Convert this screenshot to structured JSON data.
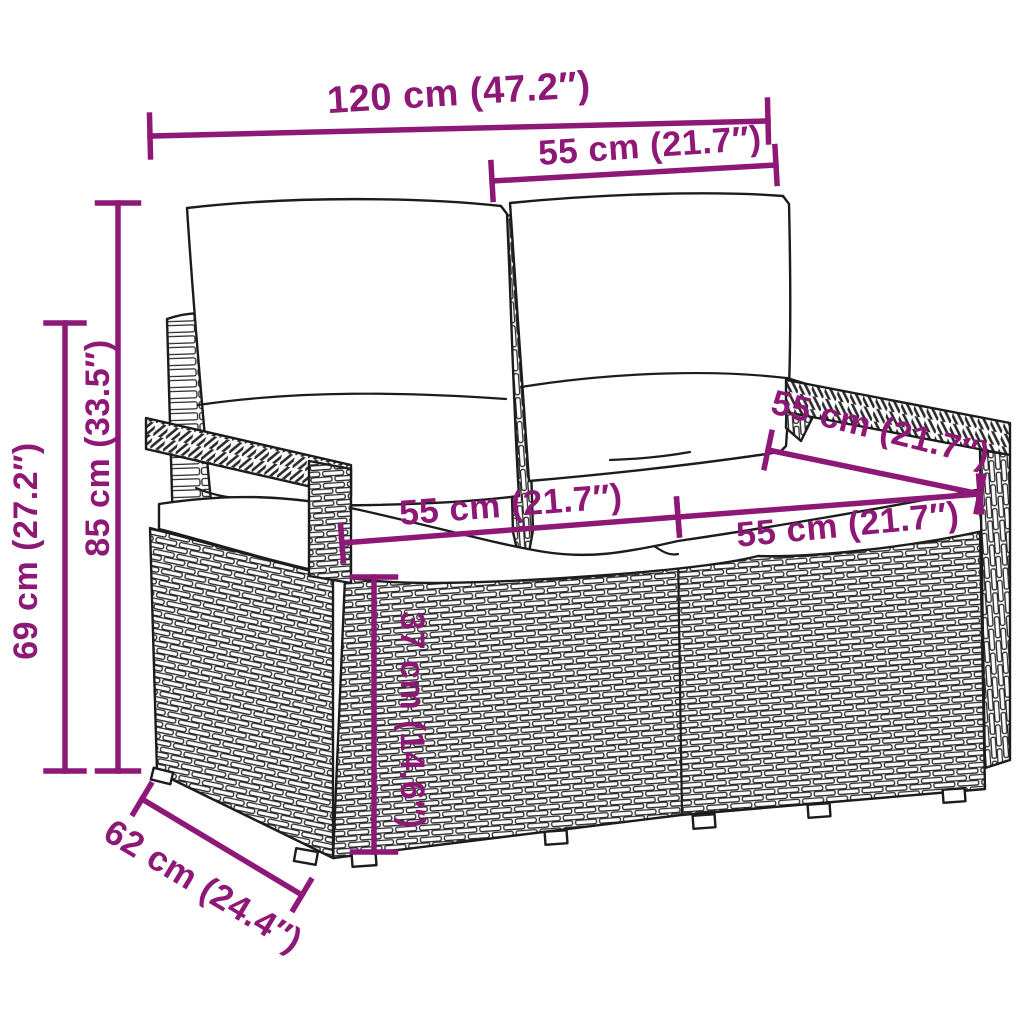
{
  "diagram": {
    "title": "Poly rattan 2-seater garden sofa with cushions — dimension diagram",
    "accent_color": "#8E1876",
    "outline_color": "#1C1C1C",
    "background_color": "#FFFFFF",
    "canvas": {
      "width": 1024,
      "height": 1024
    }
  },
  "dimensions": [
    {
      "id": "overall-width",
      "label": "120 cm (47.2″)",
      "x1": 150,
      "y1": 136,
      "x2": 768,
      "y2": 121,
      "tick": 42,
      "label_x": 459,
      "label_y": 95,
      "label_rotate": -3.5,
      "font_size": 38
    },
    {
      "id": "backrest-width-right",
      "label": "55 cm (21.7″)",
      "x1": 492,
      "y1": 181,
      "x2": 776,
      "y2": 165,
      "tick": 37,
      "label_x": 650,
      "label_y": 148,
      "label_rotate": -4,
      "font_size": 35
    },
    {
      "id": "overall-height",
      "label": "85 cm (33.5″)",
      "x1": 118,
      "y1": 203,
      "x2": 118,
      "y2": 771,
      "tick": 41,
      "label_x": 100,
      "label_y": 448,
      "label_rotate": -90,
      "font_size": 34
    },
    {
      "id": "armrest-height",
      "label": "69 cm (27.2″)",
      "x1": 65,
      "y1": 323,
      "x2": 65,
      "y2": 771,
      "tick": 38,
      "label_x": 28,
      "label_y": 551,
      "label_rotate": -90,
      "font_size": 34
    },
    {
      "id": "seat-width-left",
      "label": "55 cm (21.7″)",
      "x1": 342,
      "y1": 543,
      "x2": 678,
      "y2": 517,
      "tick": 36,
      "label_x": 511,
      "label_y": 507,
      "label_rotate": -4.5,
      "font_size": 35
    },
    {
      "id": "seat-width-right",
      "label": "55 cm (21.7″)",
      "x1": 678,
      "y1": 517,
      "x2": 980,
      "y2": 494,
      "tick": 36,
      "label_x": 848,
      "label_y": 527,
      "label_rotate": -5.5,
      "font_size": 35
    },
    {
      "id": "seat-depth-top",
      "label": "55 cm (21.7″)",
      "x1": 768,
      "y1": 450,
      "x2": 980,
      "y2": 494,
      "tick": 36,
      "label_x": 880,
      "label_y": 431,
      "label_rotate": 14,
      "font_size": 35
    },
    {
      "id": "seat-base-height",
      "label": "37 cm (14.6″)",
      "x1": 374,
      "y1": 577,
      "x2": 374,
      "y2": 852,
      "tick": 43,
      "label_x": 410,
      "label_y": 720,
      "label_rotate": 90,
      "font_size": 34
    },
    {
      "id": "overall-depth",
      "label": "62 cm (24.4″)",
      "x1": 142,
      "y1": 799,
      "x2": 302,
      "y2": 895,
      "tick": 34,
      "label_x": 202,
      "label_y": 888,
      "label_rotate": 31,
      "font_size": 35
    }
  ]
}
